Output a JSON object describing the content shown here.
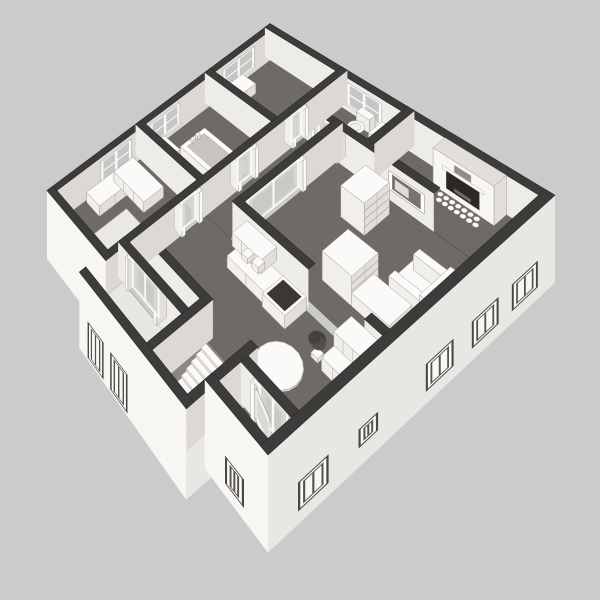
{
  "title": "3D isometric floor plan render",
  "background": "#cbcbcb",
  "palette": {
    "wallCap": "#3d3c3b",
    "wallCapEdge": "#2b2b2a",
    "faceSE": "#dcd9d4",
    "faceSW": "#eeece8",
    "extSE": "#e9e7e3",
    "extSW": "#f7f6f3",
    "floor": "#6e6a66",
    "floorLineLight": "#7d7975",
    "floorLineDark": "#605c59",
    "porchFloor": "#e9e7e3",
    "shaft": "#8a8682",
    "furnTop": "#fbfaf8",
    "furnSE": "#e2dfda",
    "furnSW": "#f1efeb",
    "furnEdge": "#a29e98",
    "glass": "#d6d4d0",
    "white": "#fafaf8",
    "darkInset": "#3a3734",
    "fireboxDark": "#2b2826",
    "windowBg": "#c6c6c6",
    "basin": "#c7c4bf",
    "artInner": "#77736e",
    "plantDark": "#45413d",
    "plantMid": "#534f4a",
    "mirror": "#8f8b86",
    "frameDark": "#4b4844",
    "paneSash": "#55524e",
    "stepFront": "#e5e3df",
    "stepSide": "#d8d5d0",
    "stepEdge": "#b0aca6"
  },
  "view": {
    "corners": [
      [
        270,
        53
      ],
      [
        550,
        233
      ],
      [
        268,
        492
      ],
      [
        50,
        220
      ]
    ],
    "planSize": 120,
    "wallHeight": 28,
    "zScale": 1.05,
    "skirtDepth": -32
  },
  "els": [
    {
      "k": "floor",
      "name": "floor-bedroom-top",
      "r": [
        3,
        3,
        38.5,
        34.5
      ],
      "c": "floor",
      "planks": true
    },
    {
      "k": "floor",
      "name": "floor-bathroom-main",
      "r": [
        3,
        37.5,
        38.5,
        72.5
      ],
      "c": "floor",
      "planks": true
    },
    {
      "k": "floor",
      "name": "floor-bedroom-left",
      "r": [
        3,
        75.5,
        38.5,
        118.5
      ],
      "c": "floor",
      "planks": true
    },
    {
      "k": "floor",
      "name": "floor-bathroom-small",
      "r": [
        41.5,
        3,
        68.5,
        20.5
      ],
      "c": "floor",
      "planks": true
    },
    {
      "k": "floor",
      "name": "floor-hallway",
      "r": [
        41.5,
        23.5,
        54.5,
        104.5
      ],
      "c": "floor",
      "planks": true
    },
    {
      "k": "floor",
      "name": "floor-living-upper",
      "r": [
        71.5,
        3,
        118.5,
        23.5
      ],
      "c": "floor",
      "planks": true
    },
    {
      "k": "floor",
      "name": "floor-living",
      "r": [
        57.5,
        23.5,
        118.5,
        70.5
      ],
      "c": "floor",
      "planks": true
    },
    {
      "k": "floor",
      "name": "floor-kitchen",
      "r": [
        41.5,
        73.5,
        118.5,
        106.5
      ],
      "c": "floor",
      "planks": true
    },
    {
      "k": "floor",
      "name": "floor-vestibule",
      "r": [
        99.5,
        109.5,
        118.5,
        118.5
      ],
      "c": "floor",
      "planks": true
    },
    {
      "k": "floor",
      "name": "floor-lower-hall",
      "r": [
        41.5,
        105.5,
        74.5,
        110.5
      ],
      "c": "floor",
      "planks": true
    },
    {
      "k": "floor",
      "name": "floor-porch",
      "r": [
        41.5,
        113.5,
        72.5,
        128.5
      ],
      "c": "porchFloor",
      "planks": false
    },
    {
      "k": "floor",
      "name": "floor-stairwell",
      "r": [
        77.5,
        104.5,
        94.5,
        129
      ],
      "c": "shaft",
      "planks": false
    },
    {
      "k": "wall",
      "name": "wall-exterior-nw",
      "axis": "v",
      "lo": 0,
      "hi": 3,
      "a": 0,
      "b": 121.5,
      "fc": "faceSE",
      "windows": [
        [
          12,
          30
        ],
        [
          54,
          70
        ],
        [
          80,
          96
        ]
      ]
    },
    {
      "k": "wall",
      "name": "wall-exterior-ne",
      "axis": "u",
      "lo": 0,
      "hi": 3,
      "a": 0,
      "b": 121.5,
      "fc": "faceSW",
      "windows": [
        [
          44,
          60
        ]
      ]
    },
    {
      "k": "fireplace",
      "name": "fireplace",
      "u0": 86,
      "u1": 108,
      "v0": 3,
      "v1": 9
    },
    {
      "k": "box",
      "name": "dresser-bedroom-top",
      "r": [
        4,
        20,
        12,
        35
      ],
      "z0": 0,
      "z1": 9,
      "seams": "u"
    },
    {
      "k": "wall",
      "name": "wall-bed1-bath",
      "axis": "u",
      "lo": 34.5,
      "hi": 37.5,
      "a": 0,
      "b": 41.5,
      "fc": "faceSW"
    },
    {
      "k": "toilet",
      "name": "toilet",
      "u0": 50,
      "v0": 3,
      "u1": 58,
      "v1": 14
    },
    {
      "k": "box",
      "name": "vanity-bathroom-small",
      "r": [
        60,
        3,
        68.5,
        10
      ],
      "z0": 0,
      "z1": 9.5,
      "seams": "u"
    },
    {
      "k": "wall",
      "name": "wall-bath2-sw",
      "axis": "u",
      "lo": 20.5,
      "hi": 23.5,
      "a": 38.5,
      "b": 97.5,
      "fc": "faceSW",
      "gaps": [
        {
          "a": 46,
          "b": 58,
          "t": "glass"
        }
      ]
    },
    {
      "k": "art",
      "name": "wall-art",
      "plane": 23.5,
      "a": 80,
      "b": 94,
      "z0": 8,
      "z1": 22
    },
    {
      "k": "wall",
      "name": "wall-bath2-se",
      "axis": "v",
      "lo": 68.5,
      "hi": 71.5,
      "a": 0,
      "b": 20.5,
      "fc": "faceSE"
    },
    {
      "k": "tub",
      "name": "bathtub",
      "r": [
        14,
        50,
        38,
        63
      ]
    },
    {
      "k": "box",
      "name": "vanity-bathroom-main",
      "r": [
        5,
        64,
        15,
        72
      ],
      "z0": 0,
      "z1": 9,
      "seams": "u"
    },
    {
      "k": "wall",
      "name": "wall-bath1-bed2",
      "axis": "u",
      "lo": 72.5,
      "hi": 75.5,
      "a": 0,
      "b": 41.5,
      "fc": "faceSW"
    },
    {
      "k": "box",
      "name": "corner-desk-long",
      "r": [
        4,
        80,
        13,
        104
      ],
      "z0": 0,
      "z1": 9,
      "seams": "u"
    },
    {
      "k": "box",
      "name": "corner-desk-short",
      "r": [
        4,
        80,
        24,
        90
      ],
      "z0": 0,
      "z1": 9,
      "seams": "v"
    },
    {
      "k": "rug",
      "name": "rug",
      "r": [
        18,
        94,
        34,
        110
      ]
    },
    {
      "k": "wall",
      "name": "wall-hall-living",
      "axis": "v",
      "lo": 54.5,
      "hi": 57.5,
      "a": 20.5,
      "b": 72.5,
      "fc": "faceSE",
      "gaps": [
        {
          "a": 40,
          "b": 68,
          "t": "glass2"
        }
      ]
    },
    {
      "k": "box",
      "name": "bookshelf",
      "r": [
        74,
        28,
        84,
        40
      ],
      "z0": 0,
      "z1": 24,
      "shelves": true
    },
    {
      "k": "box",
      "name": "cabinet-tall",
      "r": [
        86,
        50,
        98,
        62
      ],
      "z0": 0,
      "z1": 21,
      "shelves": true
    },
    {
      "k": "sideTable",
      "name": "side-table",
      "cu": 116,
      "cv": 31,
      "r": 3.6,
      "h": 8
    },
    {
      "k": "armchair",
      "name": "armchair",
      "r": [
        102,
        36,
        116,
        50
      ]
    },
    {
      "k": "box",
      "name": "kitchen-island",
      "r": [
        98,
        52,
        112,
        62
      ],
      "z0": 0,
      "z1": 9
    },
    {
      "k": "wall",
      "name": "wall-living-kitchen-a",
      "axis": "u",
      "lo": 69.5,
      "hi": 72.5,
      "a": 54.5,
      "b": 90,
      "fc": "faceSW"
    },
    {
      "k": "wall",
      "name": "wall-living-kitchen-b",
      "axis": "u",
      "lo": 69.5,
      "hi": 72.5,
      "a": 112,
      "b": 118.5,
      "fc": "faceSW"
    },
    {
      "k": "box",
      "name": "kitchen-counter",
      "r": [
        62,
        73.5,
        90,
        82
      ],
      "z0": 0,
      "z1": 9,
      "seams": "v"
    },
    {
      "k": "box",
      "name": "kitchen-wall-cabinet",
      "r": [
        63,
        73.5,
        77,
        80.5
      ],
      "z0": 16,
      "z1": 26,
      "seams": "v"
    },
    {
      "k": "box",
      "name": "stove",
      "r": [
        80,
        73.5,
        90,
        83
      ],
      "z0": 0,
      "z1": 9.5,
      "cooktop": true
    },
    {
      "k": "box",
      "name": "canister-a",
      "r": [
        66,
        76,
        69,
        79
      ],
      "z0": 9,
      "z1": 13
    },
    {
      "k": "box",
      "name": "canister-b",
      "r": [
        71,
        76,
        74,
        79
      ],
      "z0": 9,
      "z1": 14
    },
    {
      "k": "box",
      "name": "kitchen-counter-2",
      "r": [
        106,
        73.5,
        118.5,
        84
      ],
      "z0": 0,
      "z1": 9,
      "seams": "v"
    },
    {
      "k": "box",
      "name": "kitchen-wall-cabinet-2",
      "r": [
        108,
        73.5,
        118.5,
        81
      ],
      "z0": 16,
      "z1": 25,
      "seams": "v"
    },
    {
      "k": "plant",
      "name": "potted-plant",
      "cu": 102.5,
      "cv": 82
    },
    {
      "k": "tableRound",
      "name": "dining-table",
      "cu": 99.5,
      "cv": 95.5,
      "r": 7.5,
      "h": 8.5
    },
    {
      "k": "wall",
      "name": "wall-kitchen-lower",
      "axis": "u",
      "lo": 102.5,
      "hi": 105.5,
      "a": 38.5,
      "b": 77.5,
      "fc": "faceSW"
    },
    {
      "k": "wall",
      "name": "wall-hall-main",
      "axis": "v",
      "lo": 38.5,
      "hi": 41.5,
      "a": 0,
      "b": 131.5,
      "fc": "faceSE",
      "gaps": [
        {
          "a": 22,
          "b": 30,
          "t": "glass"
        },
        {
          "a": 48,
          "b": 58,
          "t": "glass"
        },
        {
          "a": 76,
          "b": 86,
          "t": "glass"
        }
      ]
    },
    {
      "k": "wall",
      "name": "wall-porch-ne",
      "axis": "u",
      "lo": 110.5,
      "hi": 113.5,
      "a": 38.5,
      "b": 74.5,
      "fc": "faceSW",
      "gaps": [
        {
          "a": 44,
          "b": 62,
          "t": "glass2"
        }
      ]
    },
    {
      "k": "wall",
      "name": "wall-porch-stairs",
      "axis": "v",
      "lo": 74.5,
      "hi": 77.5,
      "a": 102.5,
      "b": 131.5,
      "fc": "faceSE"
    },
    {
      "k": "stairs",
      "name": "staircase",
      "u0": 78,
      "u1": 95,
      "v0": 106,
      "steps": 11,
      "depth": 2.1,
      "drop": 2.0,
      "zStart": 2
    },
    {
      "k": "wall",
      "name": "wall-vestibule-w",
      "axis": "v",
      "lo": 95,
      "hi": 98,
      "a": 102.5,
      "b": 131.5,
      "fc": "faceSE",
      "skirt": [
        118.5,
        131.5
      ]
    },
    {
      "k": "wall",
      "name": "wall-vestibule-n",
      "axis": "u",
      "lo": 106.5,
      "hi": 109.5,
      "a": 98,
      "b": 118.5,
      "fc": "faceSW",
      "gaps": [
        {
          "a": 103,
          "b": 117,
          "t": "glass2"
        }
      ]
    },
    {
      "k": "openDoor",
      "name": "open-door",
      "hu": 104.5,
      "hv": 109.5,
      "tu": 113,
      "tv": 112.5,
      "h": 22
    },
    {
      "k": "wall",
      "name": "wall-exterior-sw-bed2",
      "axis": "u",
      "lo": 118.5,
      "hi": 121.5,
      "a": 0,
      "b": 41.5,
      "fc": "extSW",
      "ext": true
    },
    {
      "k": "wall",
      "name": "wall-exterior-sw-porch",
      "axis": "u",
      "lo": 128.5,
      "hi": 131.5,
      "a": 38.5,
      "b": 98,
      "fc": "extSW",
      "ext": true,
      "extWindows": [
        [
          44,
          54,
          "door"
        ],
        [
          58,
          68,
          "door"
        ]
      ]
    },
    {
      "k": "wall",
      "name": "wall-exterior-sw-vestibule",
      "axis": "u",
      "lo": 118.5,
      "hi": 121.5,
      "a": 95,
      "b": 121.5,
      "fc": "extSW",
      "ext": true,
      "extWindows": [
        [
          104,
          112,
          "win"
        ]
      ]
    },
    {
      "k": "wall",
      "name": "wall-exterior-se",
      "axis": "v",
      "lo": 118.5,
      "hi": 121.5,
      "a": 0,
      "b": 121.5,
      "fc": "extSE",
      "ext": true,
      "extWindows": [
        [
          8,
          20,
          "win"
        ],
        [
          26,
          38,
          "win"
        ],
        [
          46,
          58,
          "win"
        ],
        [
          78,
          86,
          "sm"
        ],
        [
          98,
          110,
          "win"
        ]
      ]
    }
  ]
}
